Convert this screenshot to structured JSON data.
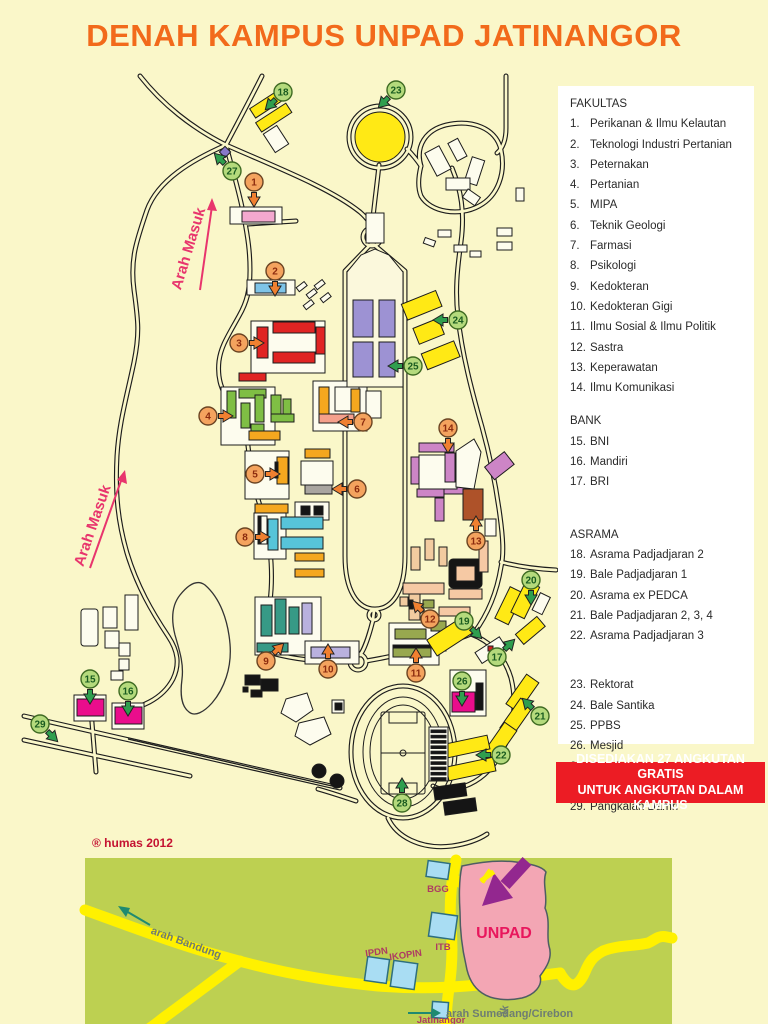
{
  "title": "DENAH KAMPUS UNPAD JATINANGOR",
  "legend": {
    "sections": [
      {
        "header": "FAKULTAS",
        "items": [
          {
            "n": "1.",
            "label": "Perikanan & Ilmu Kelautan"
          },
          {
            "n": "2.",
            "label": "Teknologi Industri Pertanian"
          },
          {
            "n": "3.",
            "label": "Peternakan"
          },
          {
            "n": "4.",
            "label": "Pertanian"
          },
          {
            "n": "5.",
            "label": "MIPA"
          },
          {
            "n": "6.",
            "label": "Teknik Geologi"
          },
          {
            "n": "7.",
            "label": "Farmasi"
          },
          {
            "n": "8.",
            "label": "Psikologi"
          },
          {
            "n": "9.",
            "label": "Kedokteran"
          },
          {
            "n": "10.",
            "label": "Kedokteran Gigi"
          },
          {
            "n": "11.",
            "label": "Ilmu Sosial & Ilmu Politik"
          },
          {
            "n": "12.",
            "label": "Sastra"
          },
          {
            "n": "13.",
            "label": "Keperawatan"
          },
          {
            "n": "14.",
            "label": "Ilmu Komunikasi"
          }
        ]
      },
      {
        "header": "BANK",
        "items": [
          {
            "n": "15.",
            "label": "BNI"
          },
          {
            "n": "16.",
            "label": "Mandiri"
          },
          {
            "n": "17.",
            "label": "BRI"
          }
        ]
      },
      {
        "header": "ASRAMA",
        "items": [
          {
            "n": "18.",
            "label": "Asrama Padjadjaran 2"
          },
          {
            "n": "19.",
            "label": "Bale Padjadjaran 1"
          },
          {
            "n": "20.",
            "label": "Asrama ex PEDCA"
          },
          {
            "n": "21.",
            "label": "Bale Padjadjaran 2, 3, 4"
          },
          {
            "n": "22.",
            "label": "Asrama Padjadjaran 3"
          }
        ]
      },
      {
        "header": "",
        "items": [
          {
            "n": "23.",
            "label": "Rektorat"
          },
          {
            "n": "24.",
            "label": "Bale Santika"
          },
          {
            "n": "25.",
            "label": "PPBS"
          },
          {
            "n": "26.",
            "label": "Mesjid"
          },
          {
            "n": "27.",
            "label": "Pos Satpam"
          },
          {
            "n": "28.",
            "label": "Stadion Jati Pajajaran"
          },
          {
            "n": "29.",
            "label": "Pangkalan Damri"
          }
        ]
      }
    ]
  },
  "banner": {
    "line1": "DISEDIAKAN 27 ANGKUTAN GRATIS",
    "line2": "UNTUK ANGKUTAN DALAM KAMPUS"
  },
  "credit": "® humas 2012",
  "map": {
    "arah_masuk_1": "Arah Masuk",
    "arah_masuk_2": "Arah Masuk",
    "markers": [
      {
        "n": 1,
        "k": "f",
        "x": 254,
        "y": 182,
        "d": "down"
      },
      {
        "n": 2,
        "k": "f",
        "x": 275,
        "y": 271,
        "d": "down"
      },
      {
        "n": 3,
        "k": "f",
        "x": 239,
        "y": 343,
        "d": "right"
      },
      {
        "n": 4,
        "k": "f",
        "x": 208,
        "y": 416,
        "d": "right"
      },
      {
        "n": 5,
        "k": "f",
        "x": 255,
        "y": 474,
        "d": "right"
      },
      {
        "n": 6,
        "k": "f",
        "x": 357,
        "y": 489,
        "d": "left"
      },
      {
        "n": 7,
        "k": "f",
        "x": 363,
        "y": 422,
        "d": "left"
      },
      {
        "n": 8,
        "k": "f",
        "x": 245,
        "y": 537,
        "d": "right"
      },
      {
        "n": 9,
        "k": "f",
        "x": 266,
        "y": 661,
        "d": "up-right"
      },
      {
        "n": 10,
        "k": "f",
        "x": 328,
        "y": 669,
        "d": "up"
      },
      {
        "n": 11,
        "k": "f",
        "x": 416,
        "y": 673,
        "d": "up"
      },
      {
        "n": 12,
        "k": "f",
        "x": 430,
        "y": 619,
        "d": "up-left"
      },
      {
        "n": 13,
        "k": "f",
        "x": 476,
        "y": 541,
        "d": "up"
      },
      {
        "n": 14,
        "k": "f",
        "x": 448,
        "y": 428,
        "d": "down"
      },
      {
        "n": 15,
        "k": "u",
        "x": 90,
        "y": 679,
        "d": "down"
      },
      {
        "n": 16,
        "k": "u",
        "x": 128,
        "y": 691,
        "d": "down"
      },
      {
        "n": 17,
        "k": "u",
        "x": 497,
        "y": 657,
        "d": "up-right"
      },
      {
        "n": 18,
        "k": "u",
        "x": 283,
        "y": 92,
        "d": "down-left"
      },
      {
        "n": 19,
        "k": "u",
        "x": 464,
        "y": 621,
        "d": "down-right"
      },
      {
        "n": 20,
        "k": "u",
        "x": 531,
        "y": 580,
        "d": "down"
      },
      {
        "n": 21,
        "k": "u",
        "x": 540,
        "y": 716,
        "d": "up-left"
      },
      {
        "n": 22,
        "k": "u",
        "x": 501,
        "y": 755,
        "d": "left"
      },
      {
        "n": 23,
        "k": "u",
        "x": 396,
        "y": 90,
        "d": "down-left"
      },
      {
        "n": 24,
        "k": "u",
        "x": 458,
        "y": 320,
        "d": "left"
      },
      {
        "n": 25,
        "k": "u",
        "x": 413,
        "y": 366,
        "d": "left"
      },
      {
        "n": 26,
        "k": "u",
        "x": 462,
        "y": 681,
        "d": "down"
      },
      {
        "n": 27,
        "k": "u",
        "x": 232,
        "y": 171,
        "d": "up-left"
      },
      {
        "n": 28,
        "k": "u",
        "x": 402,
        "y": 803,
        "d": "up"
      },
      {
        "n": 29,
        "k": "u",
        "x": 40,
        "y": 724,
        "d": "down-right"
      }
    ]
  },
  "inset": {
    "unpad": "UNPAD",
    "bgg": "BGG",
    "itb": "ITB",
    "ipdn": "IPDN",
    "ikopin": "IKOPIN",
    "jatinangor": "Jatinangor",
    "arah_bandung": "arah Bandung",
    "arah_sumedang": "arah Sumedang/Cirebon",
    "road_fragment": "ak"
  },
  "colors": {
    "title": "#F26A1B",
    "banner_bg": "#EC1C24",
    "banner_fg": "#FFFFFF",
    "page_bg": "#FAF7C9",
    "marker_fakultas": "#F4A35E",
    "marker_utility": "#B4DA7C",
    "inset_bg": "#BDD051",
    "inset_road": "#FFF100",
    "unpad_fill": "#F3A6B4"
  }
}
